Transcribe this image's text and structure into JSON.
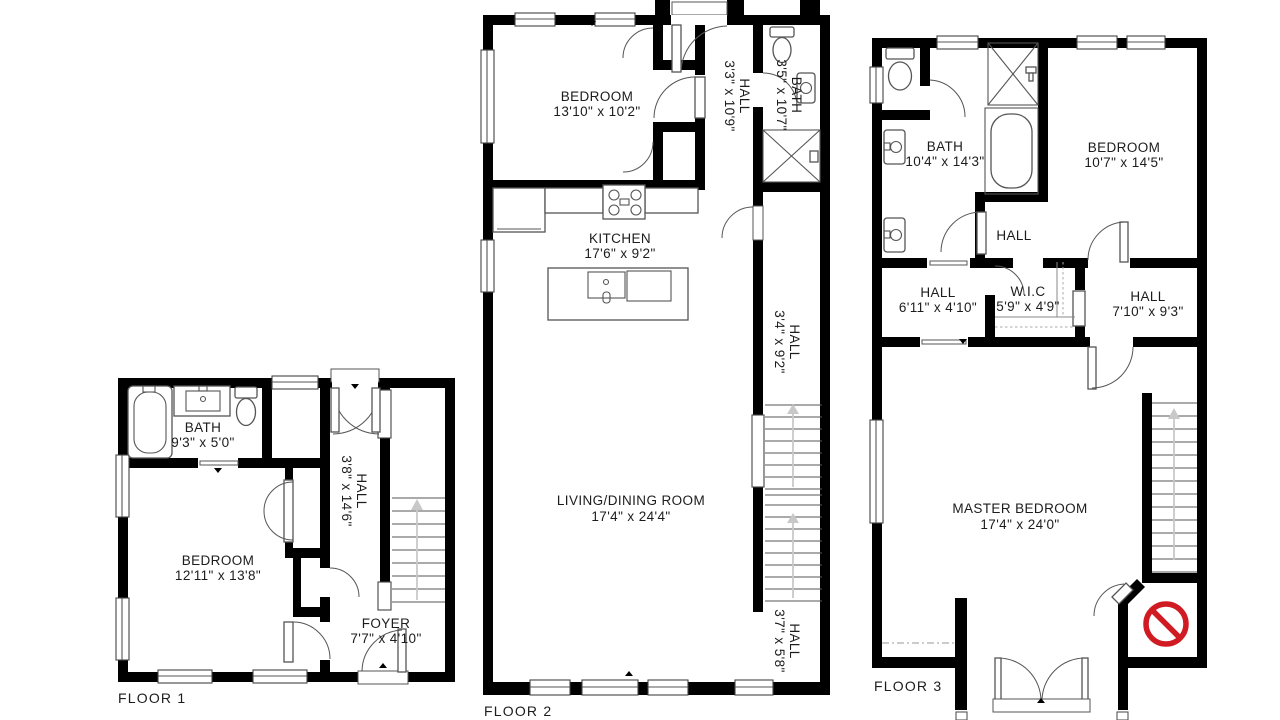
{
  "document": {
    "type": "floor-plan",
    "background": "#ffffff"
  },
  "colors": {
    "wall": "#000000",
    "fixture_stroke": "#555555",
    "no_entry_red": "#d01b22",
    "stair_arrow": "#c8c8c8"
  },
  "floor1": {
    "label": "FLOOR 1",
    "rooms": {
      "bath": {
        "name": "BATH",
        "dims": "9'3\" x 5'0\""
      },
      "bedroom": {
        "name": "BEDROOM",
        "dims": "12'11\" x 13'8\""
      },
      "hall": {
        "name": "HALL",
        "dims": "3'8\" x 14'6\""
      },
      "foyer": {
        "name": "FOYER",
        "dims": "7'7\" x 4'10\""
      }
    }
  },
  "floor2": {
    "label": "FLOOR 2",
    "rooms": {
      "bedroom": {
        "name": "BEDROOM",
        "dims": "13'10\" x 10'2\""
      },
      "hall_upper": {
        "name": "HALL",
        "dims": "3'3\" x 10'9\""
      },
      "bath": {
        "name": "BATH",
        "dims": "3'5\" x 10'7\""
      },
      "kitchen": {
        "name": "KITCHEN",
        "dims": "17'6\" x 9'2\""
      },
      "living_dining": {
        "name": "LIVING/DINING ROOM",
        "dims": "17'4\" x 24'4\""
      },
      "hall_middle": {
        "name": "HALL",
        "dims": "3'4\" x 9'2\""
      },
      "hall_lower": {
        "name": "HALL",
        "dims": "3'7\" x 5'8\""
      }
    }
  },
  "floor3": {
    "label": "FLOOR 3",
    "rooms": {
      "bath": {
        "name": "BATH",
        "dims": "10'4\" x 14'3\""
      },
      "bedroom": {
        "name": "BEDROOM",
        "dims": "10'7\" x 14'5\""
      },
      "hall_small": {
        "name": "HALL"
      },
      "hall_left": {
        "name": "HALL",
        "dims": "6'11\" x 4'10\""
      },
      "wic": {
        "name": "W.I.C",
        "dims": "5'9\" x 4'9\""
      },
      "hall_right": {
        "name": "HALL",
        "dims": "7'10\" x 9'3\""
      },
      "master_bedroom": {
        "name": "MASTER BEDROOM",
        "dims": "17'4\" x 24'0\""
      }
    }
  }
}
